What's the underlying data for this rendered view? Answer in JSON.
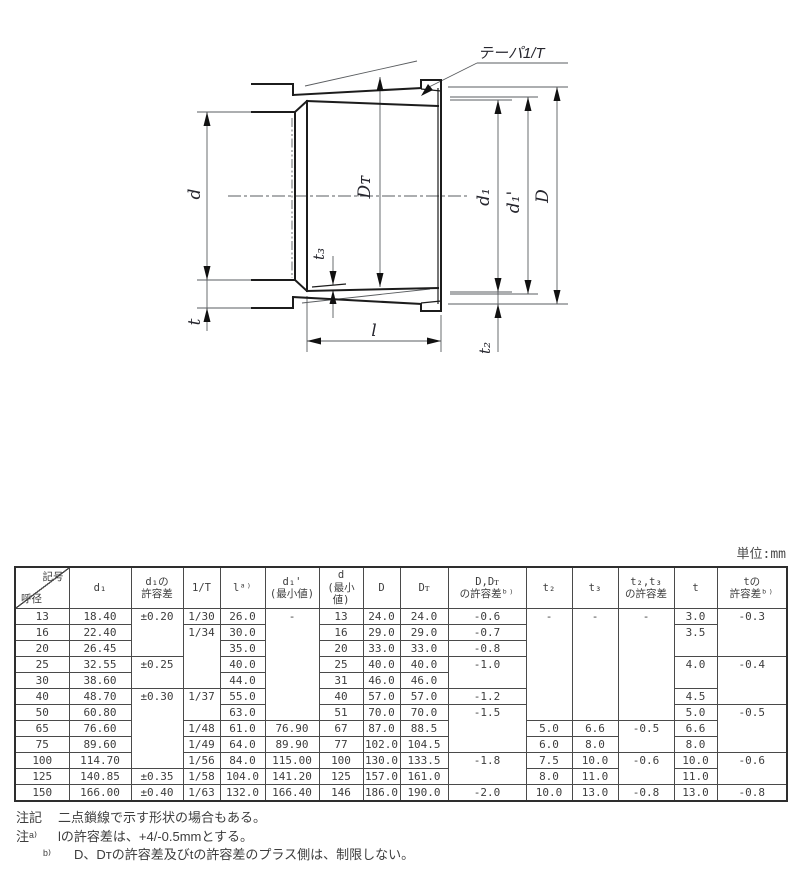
{
  "drawing": {
    "labels": {
      "taper": "テーパ1/T",
      "d": "d",
      "t": "t",
      "dt": "Dᴛ",
      "t3": "t₃",
      "l": "l",
      "d1": "d₁",
      "d1p": "d₁'",
      "D": "D",
      "t2": "t₂"
    }
  },
  "table": {
    "unit_label": "単位:mm",
    "corner": {
      "top_right": "記号",
      "bottom_left": "呼径"
    },
    "columns": [
      "d₁",
      "d₁の\n許容差",
      "1/T",
      "lᵃ⁾",
      "d₁'\n(最小値)",
      "d\n(最小値)",
      "D",
      "Dᴛ",
      "D,Dᴛ\nの許容差ᵇ⁾",
      "t₂",
      "t₃",
      "t₂,t₃\nの許容差",
      "t",
      "tの\n許容差ᵇ⁾"
    ],
    "rows": [
      [
        {
          "v": "13"
        },
        {
          "v": "18.40"
        },
        {
          "v": "±0.20",
          "rs": 3
        },
        {
          "v": "1/30"
        },
        {
          "v": "26.0"
        },
        {
          "v": "-",
          "rs": 7
        },
        {
          "v": "13"
        },
        {
          "v": "24.0"
        },
        {
          "v": "24.0"
        },
        {
          "v": "-0.6"
        },
        {
          "v": "-",
          "rs": 7
        },
        {
          "v": "-",
          "rs": 7
        },
        {
          "v": "-",
          "rs": 7
        },
        {
          "v": "3.0"
        },
        {
          "v": "-0.3",
          "rs": 3
        }
      ],
      [
        {
          "v": "16"
        },
        {
          "v": "22.40"
        },
        null,
        {
          "v": "1/34",
          "rs": 4
        },
        {
          "v": "30.0"
        },
        null,
        {
          "v": "16"
        },
        {
          "v": "29.0"
        },
        {
          "v": "29.0"
        },
        {
          "v": "-0.7"
        },
        null,
        null,
        null,
        {
          "v": "3.5",
          "rs": 2
        },
        null
      ],
      [
        {
          "v": "20"
        },
        {
          "v": "26.45"
        },
        null,
        null,
        {
          "v": "35.0"
        },
        null,
        {
          "v": "20"
        },
        {
          "v": "33.0"
        },
        {
          "v": "33.0"
        },
        {
          "v": "-0.8"
        },
        null,
        null,
        null,
        null,
        null
      ],
      [
        {
          "v": "25"
        },
        {
          "v": "32.55"
        },
        {
          "v": "±0.25",
          "rs": 2
        },
        null,
        {
          "v": "40.0"
        },
        null,
        {
          "v": "25"
        },
        {
          "v": "40.0"
        },
        {
          "v": "40.0"
        },
        {
          "v": "-1.0",
          "rs": 2
        },
        null,
        null,
        null,
        {
          "v": "4.0",
          "rs": 2
        },
        {
          "v": "-0.4",
          "rs": 3
        }
      ],
      [
        {
          "v": "30"
        },
        {
          "v": "38.60"
        },
        null,
        null,
        {
          "v": "44.0"
        },
        null,
        {
          "v": "31"
        },
        {
          "v": "46.0"
        },
        {
          "v": "46.0"
        },
        null,
        null,
        null,
        null,
        null,
        null
      ],
      [
        {
          "v": "40"
        },
        {
          "v": "48.70"
        },
        {
          "v": "±0.30",
          "rs": 5
        },
        {
          "v": "1/37",
          "rs": 2
        },
        {
          "v": "55.0"
        },
        null,
        {
          "v": "40"
        },
        {
          "v": "57.0"
        },
        {
          "v": "57.0"
        },
        {
          "v": "-1.2"
        },
        null,
        null,
        null,
        {
          "v": "4.5"
        },
        null
      ],
      [
        {
          "v": "50"
        },
        {
          "v": "60.80"
        },
        null,
        null,
        {
          "v": "63.0"
        },
        null,
        {
          "v": "51"
        },
        {
          "v": "70.0"
        },
        {
          "v": "70.0"
        },
        {
          "v": "-1.5",
          "rs": 3
        },
        null,
        null,
        null,
        {
          "v": "5.0"
        },
        {
          "v": "-0.5",
          "rs": 3
        }
      ],
      [
        {
          "v": "65"
        },
        {
          "v": "76.60"
        },
        null,
        {
          "v": "1/48"
        },
        {
          "v": "61.0"
        },
        {
          "v": "76.90"
        },
        {
          "v": "67"
        },
        {
          "v": "87.0"
        },
        {
          "v": "88.5"
        },
        null,
        {
          "v": "5.0"
        },
        {
          "v": "6.6"
        },
        {
          "v": "-0.5",
          "rs": 2
        },
        {
          "v": "6.6"
        },
        null
      ],
      [
        {
          "v": "75"
        },
        {
          "v": "89.60"
        },
        null,
        {
          "v": "1/49"
        },
        {
          "v": "64.0"
        },
        {
          "v": "89.90"
        },
        {
          "v": "77"
        },
        {
          "v": "102.0"
        },
        {
          "v": "104.5"
        },
        null,
        {
          "v": "6.0"
        },
        {
          "v": "8.0"
        },
        null,
        {
          "v": "8.0"
        },
        null
      ],
      [
        {
          "v": "100"
        },
        {
          "v": "114.70"
        },
        null,
        {
          "v": "1/56"
        },
        {
          "v": "84.0"
        },
        {
          "v": "115.00"
        },
        {
          "v": "100"
        },
        {
          "v": "130.0"
        },
        {
          "v": "133.5"
        },
        {
          "v": "-1.8",
          "rs": 2
        },
        {
          "v": "7.5"
        },
        {
          "v": "10.0"
        },
        {
          "v": "-0.6",
          "rs": 2
        },
        {
          "v": "10.0"
        },
        {
          "v": "-0.6",
          "rs": 2
        }
      ],
      [
        {
          "v": "125"
        },
        {
          "v": "140.85"
        },
        {
          "v": "±0.35"
        },
        {
          "v": "1/58"
        },
        {
          "v": "104.0"
        },
        {
          "v": "141.20"
        },
        {
          "v": "125"
        },
        {
          "v": "157.0"
        },
        {
          "v": "161.0"
        },
        null,
        {
          "v": "8.0"
        },
        {
          "v": "11.0"
        },
        null,
        {
          "v": "11.0"
        },
        null
      ],
      [
        {
          "v": "150"
        },
        {
          "v": "166.00"
        },
        {
          "v": "±0.40"
        },
        {
          "v": "1/63"
        },
        {
          "v": "132.0"
        },
        {
          "v": "166.40"
        },
        {
          "v": "146"
        },
        {
          "v": "186.0"
        },
        {
          "v": "190.0"
        },
        {
          "v": "-2.0"
        },
        {
          "v": "10.0"
        },
        {
          "v": "13.0"
        },
        {
          "v": "-0.8"
        },
        {
          "v": "13.0"
        },
        {
          "v": "-0.8"
        }
      ]
    ]
  },
  "notes": [
    {
      "label": "注記",
      "text": "二点鎖線で示す形状の場合もある。"
    },
    {
      "label": "注ᵃ⁾",
      "text": "lの許容差は、+4/-0.5mmとする。"
    },
    {
      "label": "ᵇ⁾",
      "text": "D、Dᴛの許容差及びtの許容差のプラス側は、制限しない。"
    }
  ]
}
